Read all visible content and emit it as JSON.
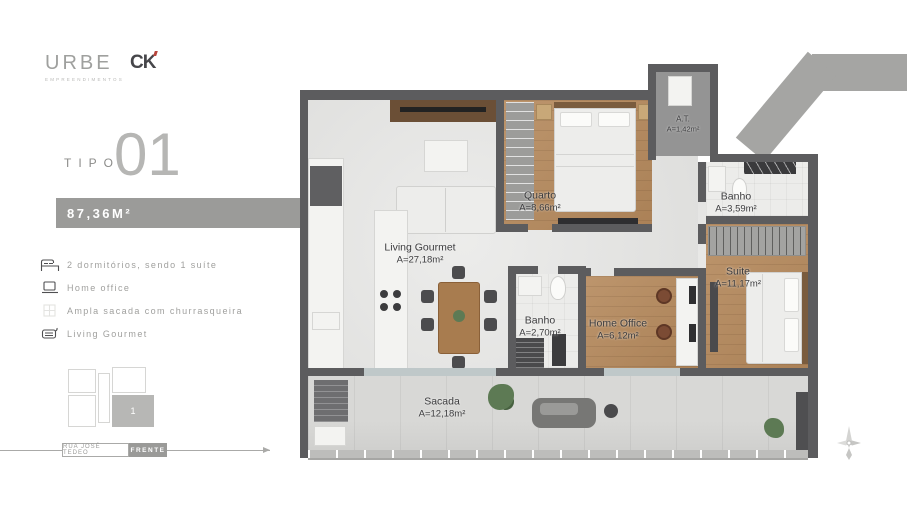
{
  "brand": {
    "logo_primary": "URBE",
    "logo_primary_sub": "EMPREENDIMENTOS",
    "logo_secondary": "CK"
  },
  "unit": {
    "type_label": "TIPO",
    "type_number": "01",
    "area_label": "87,36M²"
  },
  "features": [
    {
      "icon": "bed-icon",
      "label": "2 dormitórios, sendo 1 suíte"
    },
    {
      "icon": "laptop-icon",
      "label": "Home office"
    },
    {
      "icon": "balcony-icon",
      "label": "Ampla sacada com churrasqueira"
    },
    {
      "icon": "grill-icon",
      "label": "Living Gourmet"
    }
  ],
  "site_plan": {
    "highlighted_unit": "1"
  },
  "street": {
    "name": "RUA JOSÉ TEDEO",
    "front_label": "FRENTE"
  },
  "floor_plan": {
    "rooms": {
      "living": {
        "name": "Living Gourmet",
        "area": "A=27,18m²"
      },
      "quarto": {
        "name": "Quarto",
        "area": "A=8,66m²"
      },
      "at": {
        "name": "A.T.",
        "area": "A=1,42m²"
      },
      "banho_social": {
        "name": "Banho",
        "area": "A=3,59m²"
      },
      "suite": {
        "name": "Suite",
        "area": "A=11,17m²"
      },
      "banho": {
        "name": "Banho",
        "area": "A=2,70m²"
      },
      "home_office": {
        "name": "Home Office",
        "area": "A=6,12m²"
      },
      "sacada": {
        "name": "Sacada",
        "area": "A=12,18m²"
      }
    }
  },
  "colors": {
    "accent_gray": "#9b9b99",
    "wall": "#5c5c5e",
    "wood": "#b5895c",
    "highlight": "#b7b7b5"
  }
}
